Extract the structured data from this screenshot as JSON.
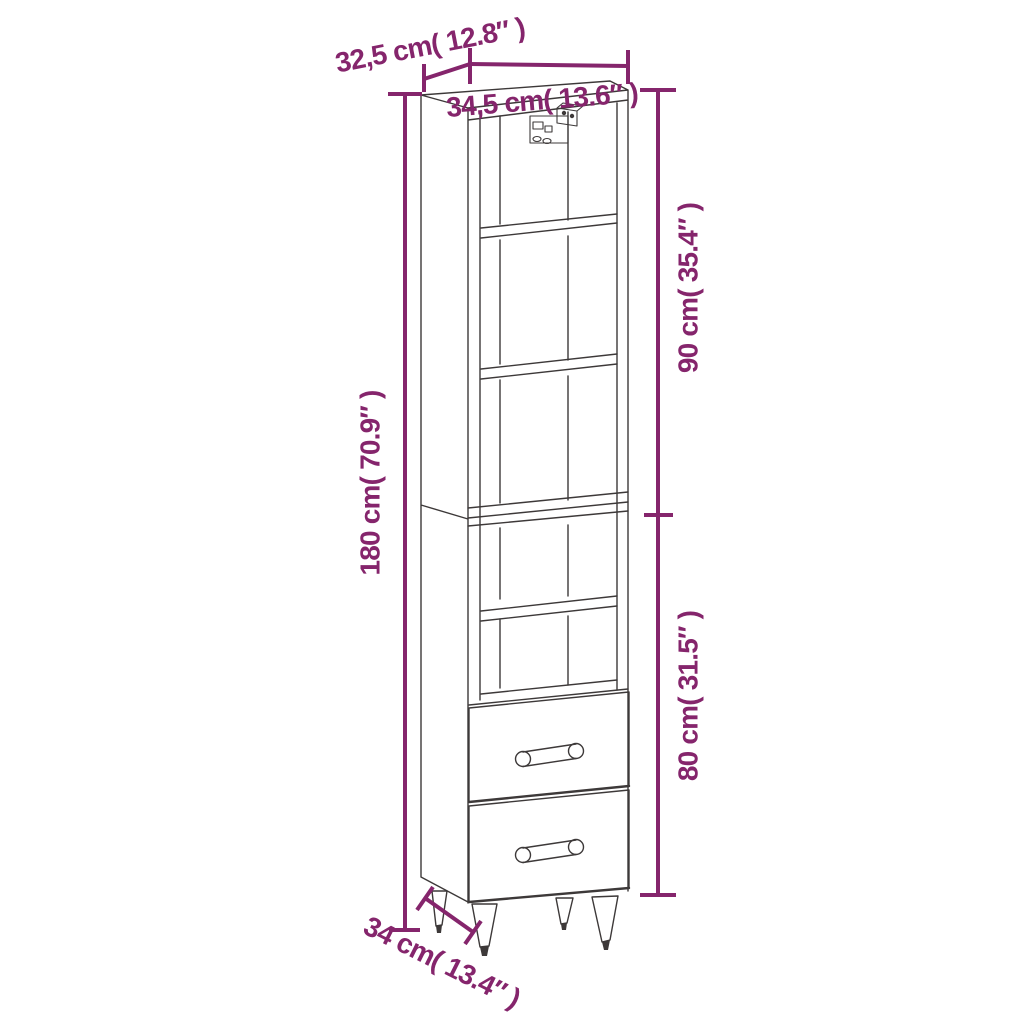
{
  "diagram": {
    "subject": "tall-cabinet-with-shelves-and-two-drawers",
    "accent_color": "#85256C",
    "outline_color": "#3d3939",
    "labels": {
      "top_depth": "32,5 cm( 12.8″ )",
      "top_width": "34,5 cm( 13.6″ )",
      "right_upper": "90 cm( 35.4″ )",
      "left_total": "180 cm( 70.9″ )",
      "right_lower": "80 cm( 31.5″ )",
      "bottom_depth": "34 cm( 13.4″ )"
    }
  }
}
